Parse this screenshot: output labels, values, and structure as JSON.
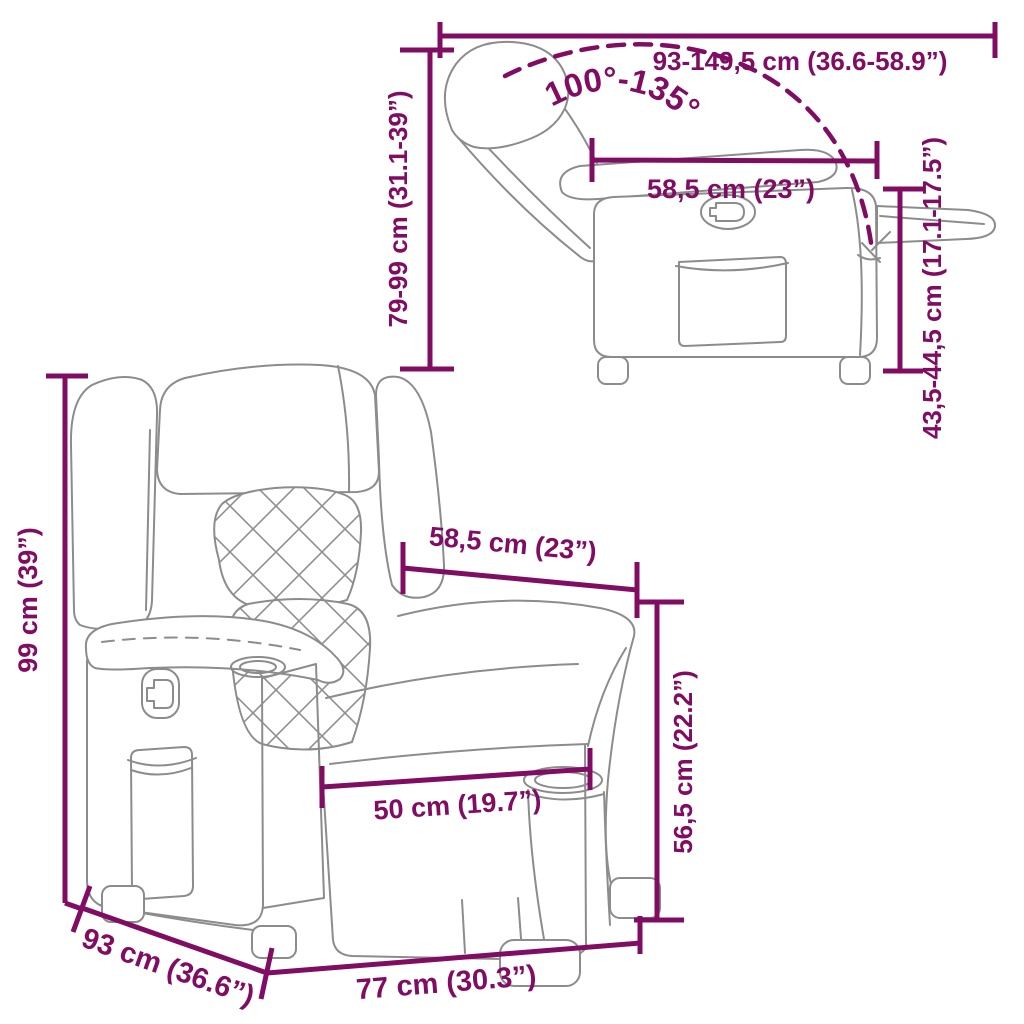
{
  "diagram": {
    "type": "product-dimension-diagram",
    "product": "recliner chair line drawing, front view and reclined side view"
  },
  "colors": {
    "dimension_lines": "#800D63",
    "chair_outline": "#8C8C8C",
    "background": "#FFFFFF"
  },
  "side_view": {
    "dim_total_length": "93-149,5 cm (36.6-58.9”)",
    "dim_recline_angle": "100°-135°",
    "dim_back_height": "79-99 cm (31.1-39”)",
    "dim_seat_depth": "58,5 cm (23”)",
    "dim_seat_height": "43,5-44,5 cm (17.1-17.5”)"
  },
  "front_view": {
    "dim_total_height": "99 cm (39”)",
    "dim_back_width": "58,5 cm (23”)",
    "dim_armrest_height": "56,5 cm (22.2”)",
    "dim_seat_width": "50 cm (19.7”)",
    "dim_total_depth": "93 cm (36.6”)",
    "dim_total_width": "77 cm (30.3”)"
  }
}
